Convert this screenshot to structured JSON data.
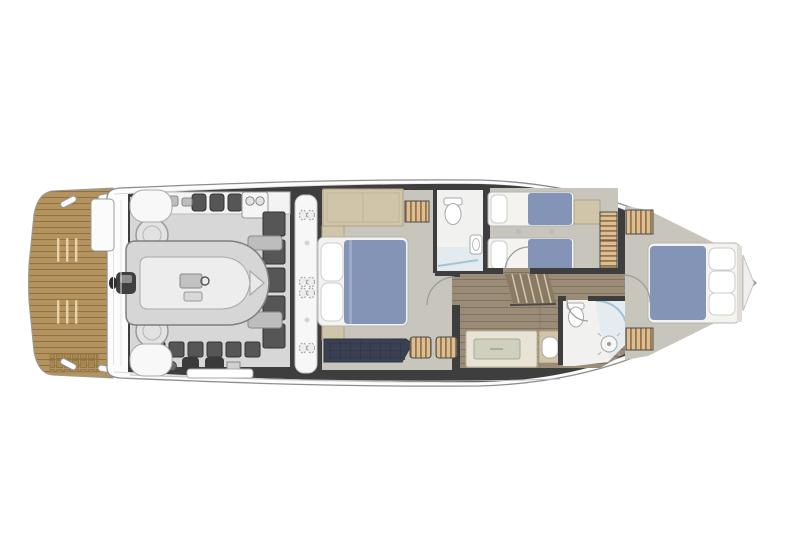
{
  "canvas": {
    "width": 800,
    "height": 533,
    "background": "#ffffff"
  },
  "colors": {
    "bg": "#ffffff",
    "hullFill": "#fcfcfc",
    "hullStroke": "#8e8e8e",
    "hullInner": "#d8d8d8",
    "wall": "#3e3e3e",
    "deckWhite": "#f7f7f7",
    "engineFloor": "#d7d7d7",
    "equip": "#565656",
    "equipDark": "#333333",
    "carpet": "#c8c5bc",
    "teak": "#b5935f",
    "teakLine": "#8f7244",
    "teakLight": "#ecd9ae",
    "teakDark": "#a9884f",
    "wood": "#9a8c77",
    "woodLine": "#80735f",
    "stairWood": "#8a7a64",
    "stairTread": "#d3c8b4",
    "bedWhite": "#f4f3f0",
    "bedStroke": "#b5b5b5",
    "pillow": "#ffffff",
    "pillowStroke": "#cccccc",
    "bedBlue": "#8494b7",
    "bedBlueFold": "#9dabc9",
    "sofaNavy": "#3a4152",
    "tuftLine": "#2c3240",
    "tan": "#d0c4a9",
    "tanDark": "#b2a383",
    "rattanLight": "#dcbe92",
    "rattanDark": "#96764c",
    "rattanFrame": "#4a4a4a",
    "cream": "#e9e3d5",
    "sage": "#cfd0bd",
    "bathFloor": "#f1f1ef",
    "fixture": "#ffffff",
    "fixtureStroke": "#a8a8a8",
    "showerFloor": "#e3ebee",
    "showerGlass": "#9fc6d4",
    "doorArc": "#9a9a9a",
    "grayMid": "#bdbdbd"
  },
  "areas": [
    {
      "id": "swim-platform",
      "label": "Teak swim platform"
    },
    {
      "id": "stern-deck",
      "label": "Transom deck"
    },
    {
      "id": "tender-garage",
      "label": "Tender garage with inflatable dinghy"
    },
    {
      "id": "engine-room",
      "label": "Engine room machinery"
    },
    {
      "id": "technical-passage",
      "label": "Technical passage with deck hatches"
    },
    {
      "id": "master-cabin",
      "label": "Master cabin"
    },
    {
      "id": "master-bathroom",
      "label": "Master ensuite bathroom"
    },
    {
      "id": "twin-cabin",
      "label": "Twin guest cabin"
    },
    {
      "id": "staircase",
      "label": "Companionway staircase"
    },
    {
      "id": "corridor",
      "label": "Lower-deck corridor"
    },
    {
      "id": "day-head",
      "label": "Guest bathroom with shower"
    },
    {
      "id": "vip-cabin",
      "label": "VIP bow cabin"
    },
    {
      "id": "hull",
      "label": "Hull outline"
    },
    {
      "id": "doors",
      "label": "Door swings"
    }
  ]
}
